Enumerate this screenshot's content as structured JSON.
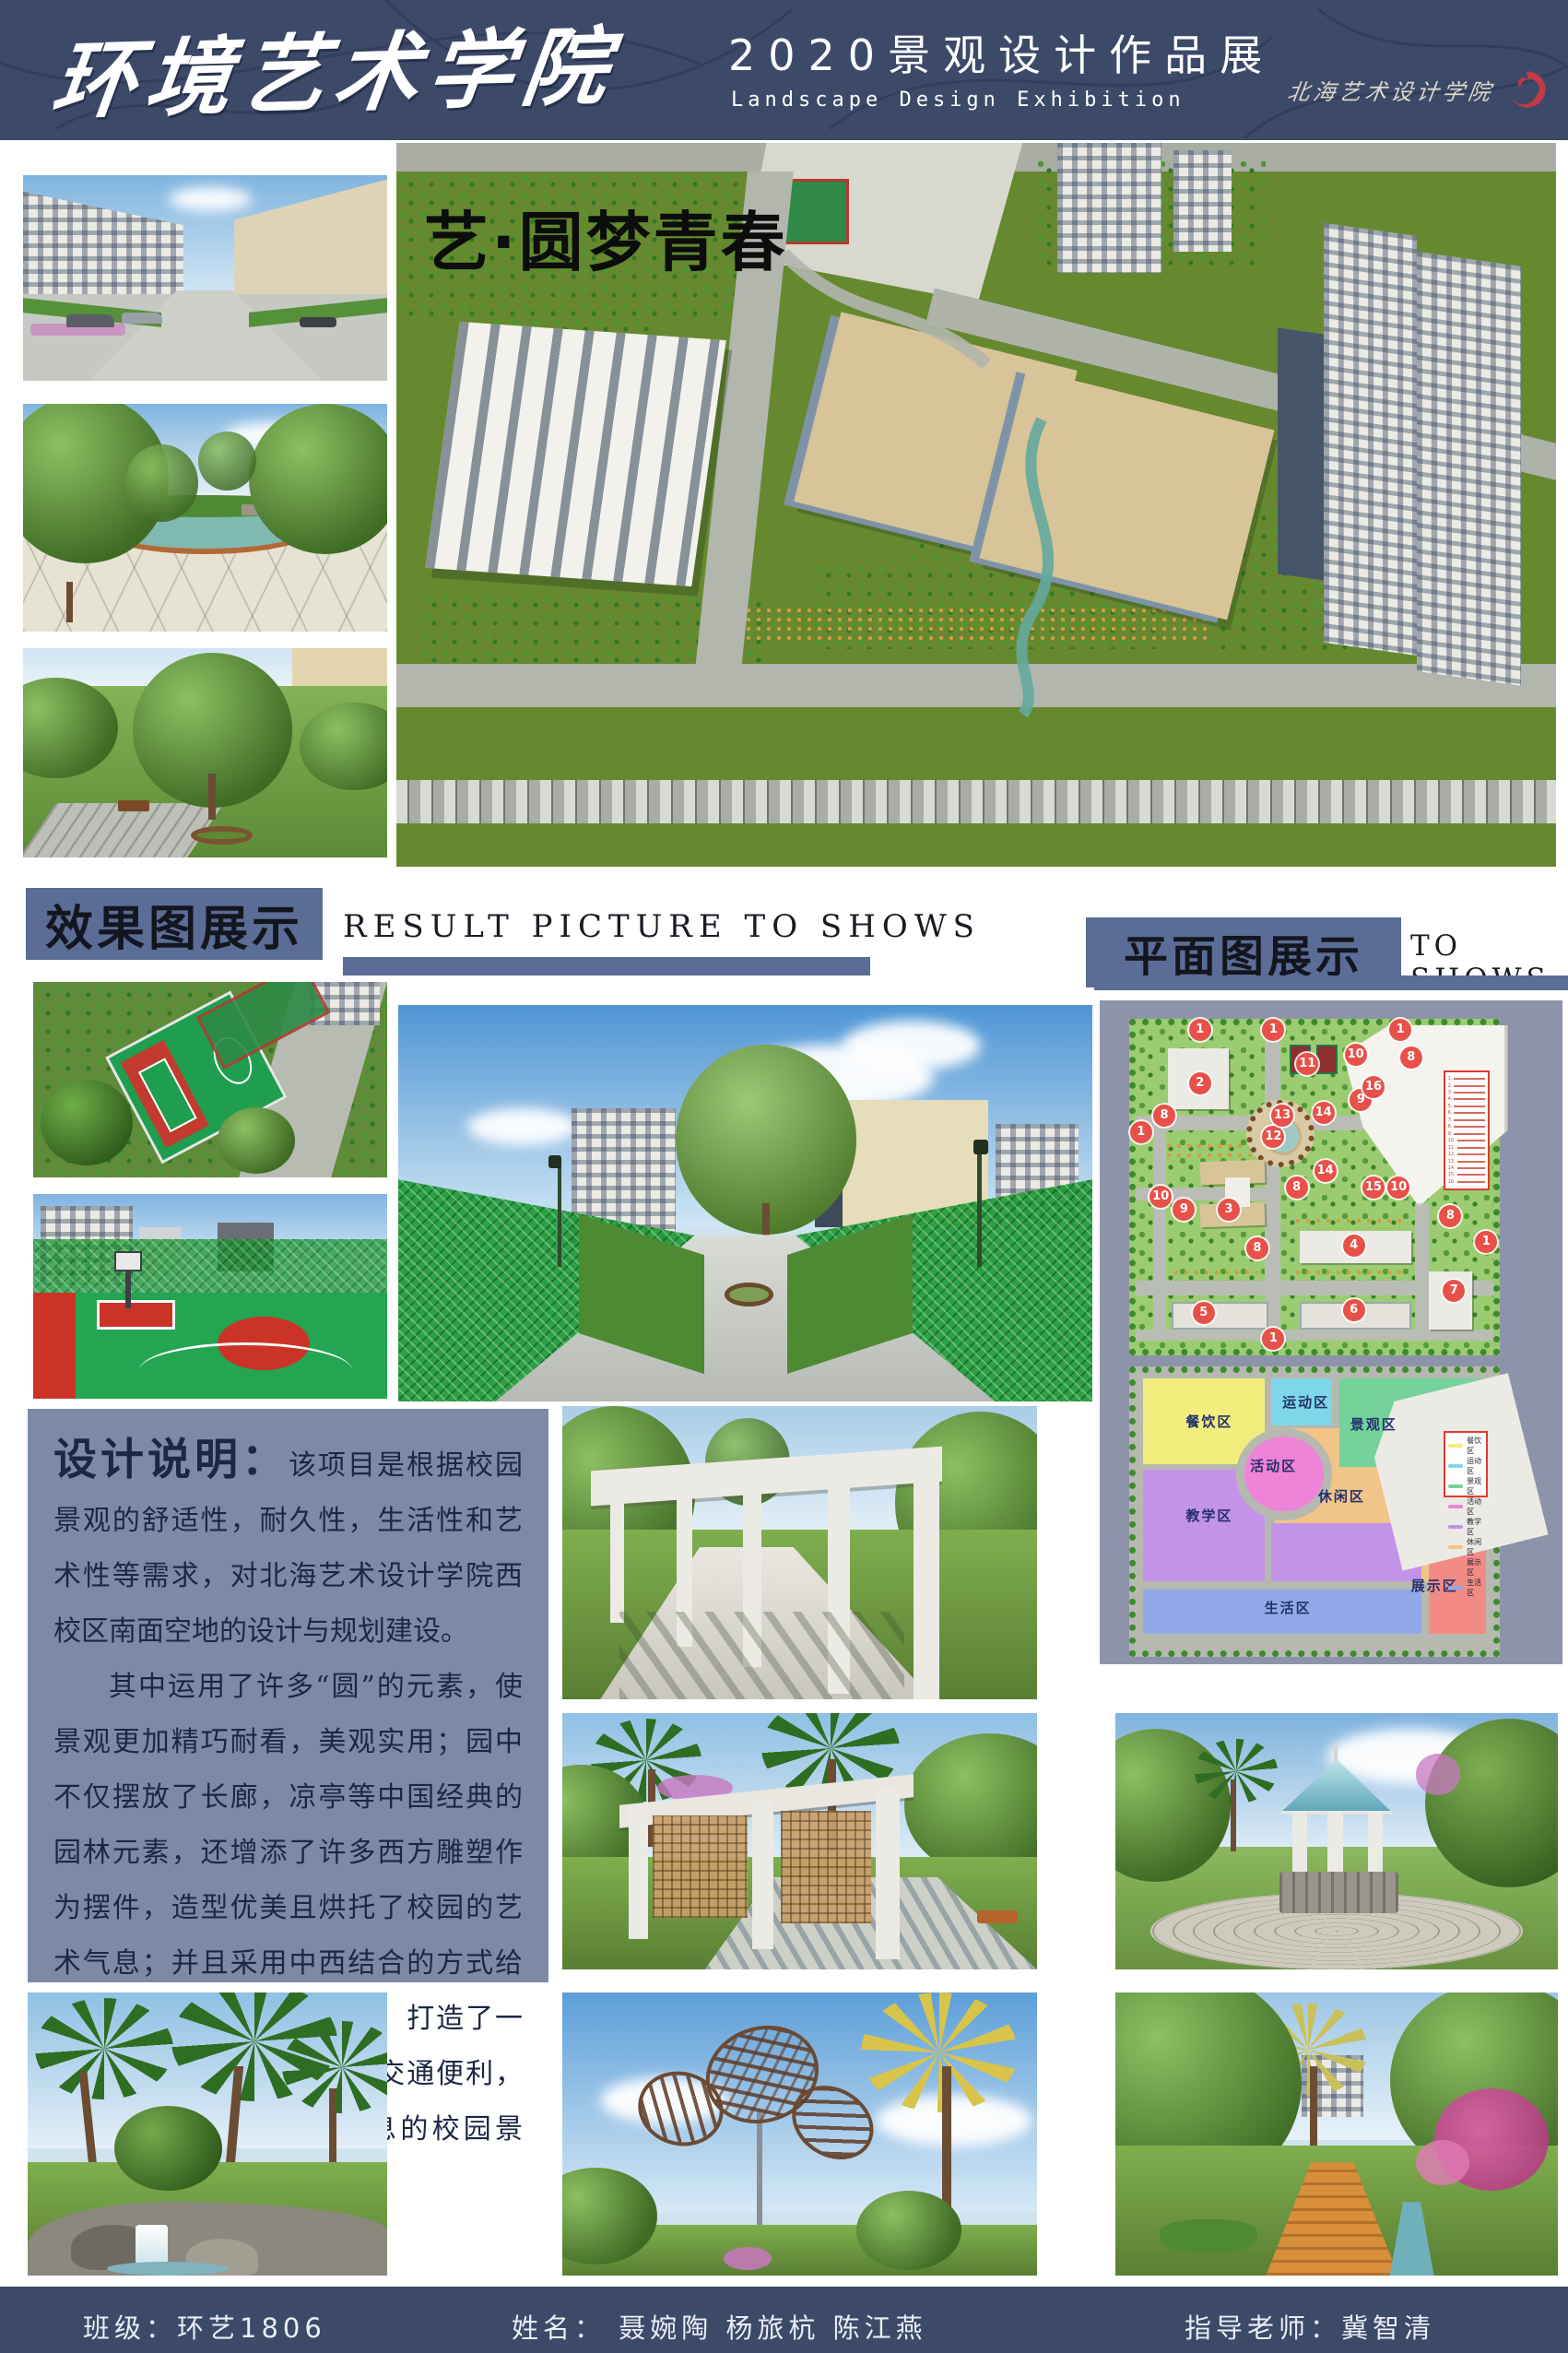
{
  "header": {
    "bg": "#3d4969",
    "college_name": "环境艺术学院",
    "exhibition_title": "2020景观设计作品展",
    "exhibition_subtitle": "Landscape Design Exhibition",
    "school_name": "北海艺术设计学院"
  },
  "hero": {
    "title": "艺·圆梦青春"
  },
  "sections": {
    "results": {
      "title_cn": "效果图展示",
      "title_en": "RESULT PICTURE TO SHOWS"
    },
    "plans": {
      "title_cn": "平面图展示",
      "title_en": "TO SHOWS"
    }
  },
  "description": {
    "heading": "设计说明：",
    "para1": "该项目是根据校园景观的舒适性，耐久性，生活性和艺术性等需求，对北海艺术设计学院西校区南面空地的设计与规划建设。",
    "para2": "其中运用了许多“圆”的元素，使景观更加精巧耐看，美观实用；园中不仅摆放了长廊，凉亭等中国经典的园林元素，还增添了许多西方雕塑作为摆件，造型优美且烘托了校园的艺术气息；并且采用中西结合的方式给人们带来丰富的视觉体验。打造了一个布局合理，功能齐全，交通便利，环境优美且充满艺术气息的校园景观。"
  },
  "site_plan": {
    "legend_numbers": [
      "1",
      "2",
      "3",
      "4",
      "5",
      "6",
      "7",
      "8",
      "9",
      "10",
      "11",
      "12",
      "13",
      "14",
      "15",
      "16"
    ],
    "markers": [
      {
        "n": "1",
        "x": 18,
        "y": 1.5
      },
      {
        "n": "1",
        "x": 38.5,
        "y": 1.5
      },
      {
        "n": "1",
        "x": 74,
        "y": 1.5
      },
      {
        "n": "1",
        "x": 1.5,
        "y": 33
      },
      {
        "n": "1",
        "x": 38.5,
        "y": 97
      },
      {
        "n": "1",
        "x": 98,
        "y": 67
      },
      {
        "n": "2",
        "x": 18,
        "y": 18
      },
      {
        "n": "3",
        "x": 26,
        "y": 57
      },
      {
        "n": "4",
        "x": 61,
        "y": 68
      },
      {
        "n": "5",
        "x": 19,
        "y": 89
      },
      {
        "n": "6",
        "x": 61,
        "y": 88
      },
      {
        "n": "7",
        "x": 89,
        "y": 82
      },
      {
        "n": "8",
        "x": 8,
        "y": 28
      },
      {
        "n": "8",
        "x": 77,
        "y": 10
      },
      {
        "n": "8",
        "x": 45,
        "y": 50
      },
      {
        "n": "8",
        "x": 34,
        "y": 69
      },
      {
        "n": "8",
        "x": 88,
        "y": 59
      },
      {
        "n": "9",
        "x": 63,
        "y": 23
      },
      {
        "n": "9",
        "x": 13.5,
        "y": 57
      },
      {
        "n": "10",
        "x": 61.5,
        "y": 9
      },
      {
        "n": "10",
        "x": 7,
        "y": 53
      },
      {
        "n": "10",
        "x": 73.5,
        "y": 50
      },
      {
        "n": "11",
        "x": 48,
        "y": 12
      },
      {
        "n": "12",
        "x": 38.5,
        "y": 34.5
      },
      {
        "n": "13",
        "x": 41,
        "y": 28
      },
      {
        "n": "14",
        "x": 52.5,
        "y": 27
      },
      {
        "n": "14",
        "x": 53,
        "y": 45
      },
      {
        "n": "15",
        "x": 66.5,
        "y": 50
      },
      {
        "n": "16",
        "x": 66.5,
        "y": 19
      }
    ]
  },
  "zoning_plan": {
    "zones": [
      {
        "label": "餐饮区",
        "color": "#f2ee7d",
        "x": 14,
        "y": 14
      },
      {
        "label": "运动区",
        "color": "#7ed7e8",
        "x": 41,
        "y": 7
      },
      {
        "label": "景观区",
        "color": "#74d29b",
        "x": 60,
        "y": 15
      },
      {
        "label": "活动区",
        "color": "#ef83d7",
        "x": 32,
        "y": 30
      },
      {
        "label": "休闲区",
        "color": "#f1c487",
        "x": 51,
        "y": 41
      },
      {
        "label": "教学区",
        "color": "#c393e9",
        "x": 14,
        "y": 48
      },
      {
        "label": "生活区",
        "color": "#92a9e9",
        "x": 36,
        "y": 81
      },
      {
        "label": "展示区",
        "color": "#f28b84",
        "x": 77,
        "y": 73
      }
    ],
    "legend": [
      {
        "label": "餐饮区",
        "color": "#f2ee7d"
      },
      {
        "label": "运动区",
        "color": "#7ed7e8"
      },
      {
        "label": "景观区",
        "color": "#74d29b"
      },
      {
        "label": "活动区",
        "color": "#ef83d7"
      },
      {
        "label": "教学区",
        "color": "#c393e9"
      },
      {
        "label": "休闲区",
        "color": "#f1c487"
      },
      {
        "label": "展示区",
        "color": "#f28b84"
      },
      {
        "label": "生活区",
        "color": "#92a9e9"
      }
    ]
  },
  "footer": {
    "class_label": "班级：环艺1806",
    "names_label": "姓名：  聂婉陶  杨旅杭  陈江燕",
    "advisor_label": "指导老师：冀智清"
  }
}
